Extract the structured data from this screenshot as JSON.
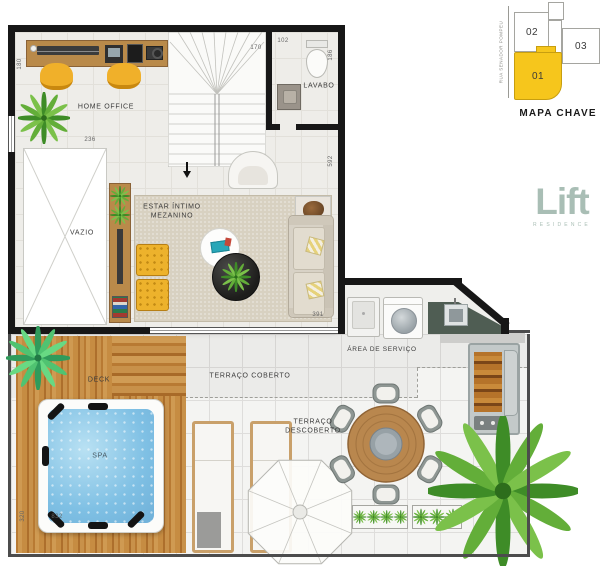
{
  "plan": {
    "labels": {
      "home_office": "HOME OFFICE",
      "lavabo": "LAVABO",
      "estar_line1": "ESTAR ÍNTIMO",
      "estar_line2": "MEZANINO",
      "vazio": "VAZIO",
      "area_servico": "ÁREA DE SERVIÇO",
      "terraco_coberto": "TERRAÇO COBERTO",
      "terraco_descoberto_line1": "TERRAÇO",
      "terraco_descoberto_line2": "DESCOBERTO",
      "deck": "DECK",
      "spa": "SPA"
    },
    "dimensions": {
      "home_office_left": "180",
      "vazio_top": "236",
      "stairs_top": "170",
      "lavabo_top": "102",
      "lavabo_right": "186",
      "estar_right": "592",
      "estar_bottom": "391",
      "deck_left": "320",
      "deck_bottom": "832"
    }
  },
  "keymap": {
    "title": "MAPA CHAVE",
    "street_name": "RUA SENADOR POMPEU",
    "units": [
      {
        "id": "02",
        "highlighted": false
      },
      {
        "id": "03",
        "highlighted": false
      },
      {
        "id": "01",
        "highlighted": true
      }
    ],
    "highlight_color": "#F6C61C"
  },
  "brand": {
    "name": "Lift",
    "subtitle": "RESIDENCE",
    "color": "#A9BEB5"
  },
  "palette": {
    "wall": "#171717",
    "deck_wood": "#C8914A",
    "spa_water": "#85C4E6",
    "accent_yellow": "#EFB32B",
    "carpet": "#D8D1C1",
    "counter_dark": "#4F5D53"
  }
}
